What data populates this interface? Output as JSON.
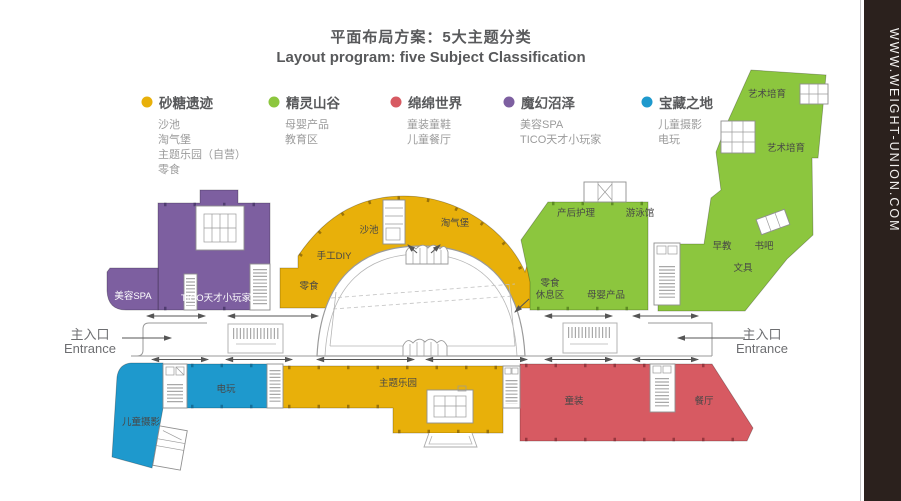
{
  "watermark": {
    "url": "WWW.WEIGHT-UNION.COM"
  },
  "title": {
    "zh": "平面布局方案：5大主题分类",
    "en": "Layout program: five Subject Classification"
  },
  "legend": [
    {
      "name": "砂糖遗迹",
      "color": "#E8B00A",
      "items": [
        "沙池",
        "淘气堡",
        "主题乐园（自营）",
        "零食"
      ]
    },
    {
      "name": "精灵山谷",
      "color": "#8CC63E",
      "items": [
        "母婴产品",
        "教育区"
      ]
    },
    {
      "name": "绵绵世界",
      "color": "#D75A62",
      "items": [
        "童装童鞋",
        "儿童餐厅"
      ]
    },
    {
      "name": "魔幻沼泽",
      "color": "#7D5FA0",
      "items": [
        "美容SPA",
        "TICO天才小玩家"
      ]
    },
    {
      "name": "宝藏之地",
      "color": "#1E99CD",
      "items": [
        "儿童摄影",
        "电玩"
      ]
    }
  ],
  "entrance": {
    "left": {
      "zh": "主入口",
      "en": "Entrance"
    },
    "right": {
      "zh": "主入口",
      "en": "Entrance"
    }
  },
  "zones": {
    "spa": "美容SPA",
    "tico": "TICO天才小玩家",
    "snack_w": "零食",
    "diy": "手工DIY",
    "sand_pool": "沙池",
    "castle": "淘气堡",
    "postpartum": "产后护理",
    "swimming": "游泳馆",
    "snack_e": "零食",
    "rest_area": "休息区",
    "maternal": "母婴产品",
    "early_edu": "早教",
    "book_bar": "书吧",
    "stationery": "文具",
    "art_top": "艺术培育",
    "art_mid": "艺术培育",
    "arcade": "电玩",
    "photo": "儿童摄影",
    "theme_park": "主题乐园",
    "kids_wear": "童装",
    "restaurant": "餐厅"
  },
  "colors": {
    "yellow": "#E8B00A",
    "green": "#8CC63E",
    "red": "#D75A62",
    "purple": "#7D5FA0",
    "blue": "#1E99CD",
    "strip_bg": "#2B211D",
    "title_text": "#58595B"
  }
}
